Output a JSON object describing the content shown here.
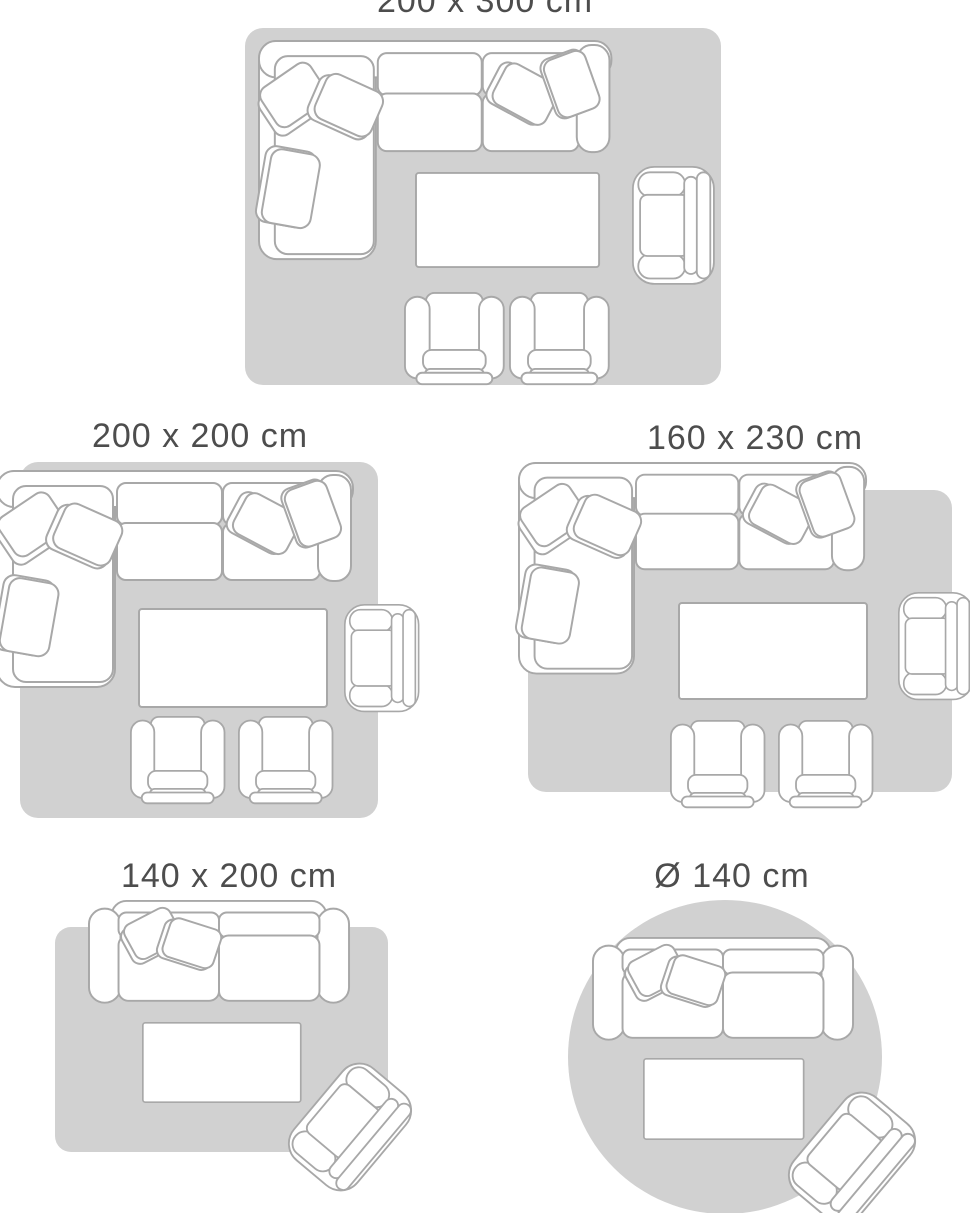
{
  "colors": {
    "background": "#ffffff",
    "rug": "#d1d1d1",
    "furniture-fill": "#ffffff",
    "furniture-outline": "#a8a8a8",
    "label-text": "#4d4d4d"
  },
  "layouts": [
    {
      "label": "200 x 300 cm",
      "rug_shape": "rectangle",
      "furniture": [
        "corner-sofa",
        "coffee-table",
        "armchair",
        "chair",
        "chair"
      ]
    },
    {
      "label": "200 x 200 cm",
      "rug_shape": "square",
      "furniture": [
        "corner-sofa",
        "coffee-table",
        "armchair",
        "chair",
        "chair"
      ]
    },
    {
      "label": "160 x 230 cm",
      "rug_shape": "rectangle",
      "furniture": [
        "corner-sofa",
        "coffee-table",
        "armchair",
        "chair",
        "chair"
      ]
    },
    {
      "label": "140 x 200 cm",
      "rug_shape": "rectangle",
      "furniture": [
        "two-seater-sofa",
        "coffee-table",
        "armchair"
      ]
    },
    {
      "label": "Ø 140 cm",
      "rug_shape": "circle",
      "furniture": [
        "two-seater-sofa",
        "coffee-table",
        "armchair"
      ]
    }
  ]
}
